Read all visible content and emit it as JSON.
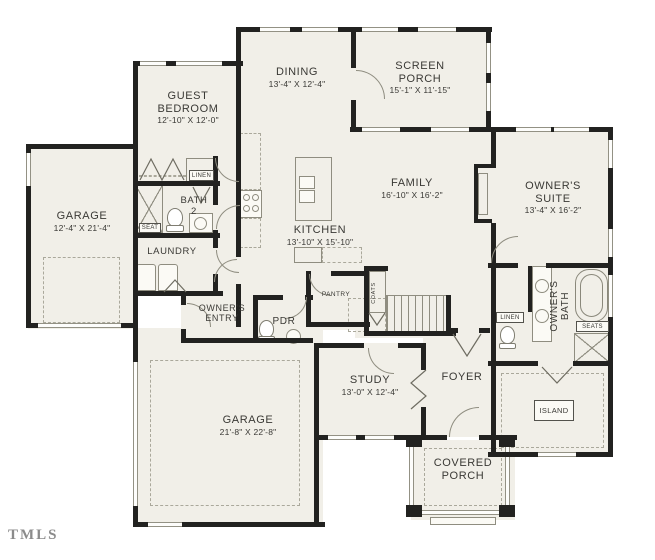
{
  "watermark": "TMLS",
  "colors": {
    "wall": "#222220",
    "floor": "#f1efe8",
    "fixture_line": "#8f8d80",
    "text": "#3a3935"
  },
  "rooms": {
    "guest_bedroom": {
      "name": "GUEST BEDROOM",
      "dims": "12'-10\" X 12'-0\""
    },
    "dining": {
      "name": "DINING",
      "dims": "13'-4\" X 12'-4\""
    },
    "screen_porch": {
      "name": "SCREEN PORCH",
      "dims": "15'-1\" X 11'-15\""
    },
    "family": {
      "name": "FAMILY",
      "dims": "16'-10\" X 16'-2\""
    },
    "owners_suite": {
      "name": "OWNER'S SUITE",
      "dims": "13'-4\" X 16'-2\""
    },
    "kitchen": {
      "name": "KITCHEN",
      "dims": "13'-10\" X 15'-10\""
    },
    "garage_side": {
      "name": "GARAGE",
      "dims": "12'-4\" X 21'-4\""
    },
    "garage_main": {
      "name": "GARAGE",
      "dims": "21'-8\" X 22'-8\""
    },
    "study": {
      "name": "STUDY",
      "dims": "13'-0\" X 12'-4\""
    },
    "foyer": {
      "name": "FOYER"
    },
    "covered_porch": {
      "name": "COVERED PORCH"
    },
    "owners_entry": {
      "name": "OWNER'S ENTRY"
    },
    "pdr": {
      "name": "PDR"
    },
    "pantry": {
      "name": "PANTRY"
    },
    "coats": {
      "name": "COATS"
    },
    "laundry": {
      "name": "LAUNDRY"
    },
    "bath2": {
      "name": "BATH 2"
    },
    "owners_bath": {
      "name": "OWNER'S BATH"
    }
  },
  "closet_labels": {
    "linen_hall": "LINEN",
    "linen_bath": "LINEN",
    "seat": "SEAT",
    "seats": "SEATS",
    "island": "ISLAND"
  }
}
